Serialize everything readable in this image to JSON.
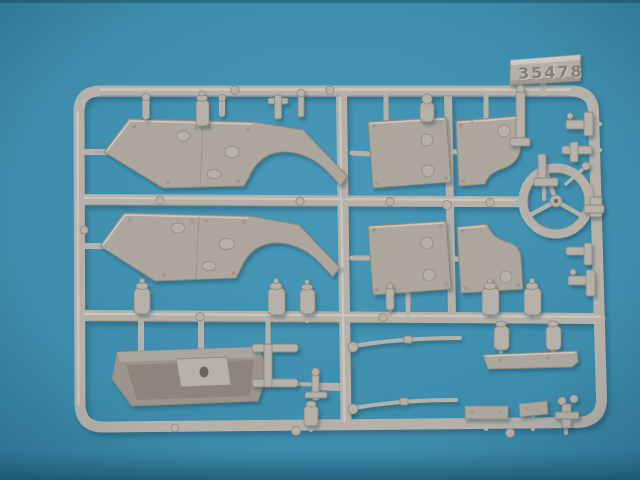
{
  "scene": {
    "subject": "Injection-molded plastic model kit sprue (light grey styrene) photographed on a teal backdrop",
    "part_number": "35478"
  },
  "colors": {
    "backdrop_center": "#4899b9",
    "backdrop_mid": "#3d8cab",
    "backdrop_edge": "#347f9e",
    "backdrop_bottom": "#2b7392",
    "plastic": "#b6b1a8",
    "plastic_highlight": "#d4cfc7",
    "plastic_shadow": "#8f897f",
    "part_face": "#aca69d",
    "part_face_dark": "#9f988e",
    "tub_face": "#9c948a",
    "tub_inner": "#8a8278",
    "tub_hole": "#6d655c",
    "emboss_digits": "#857f75"
  }
}
